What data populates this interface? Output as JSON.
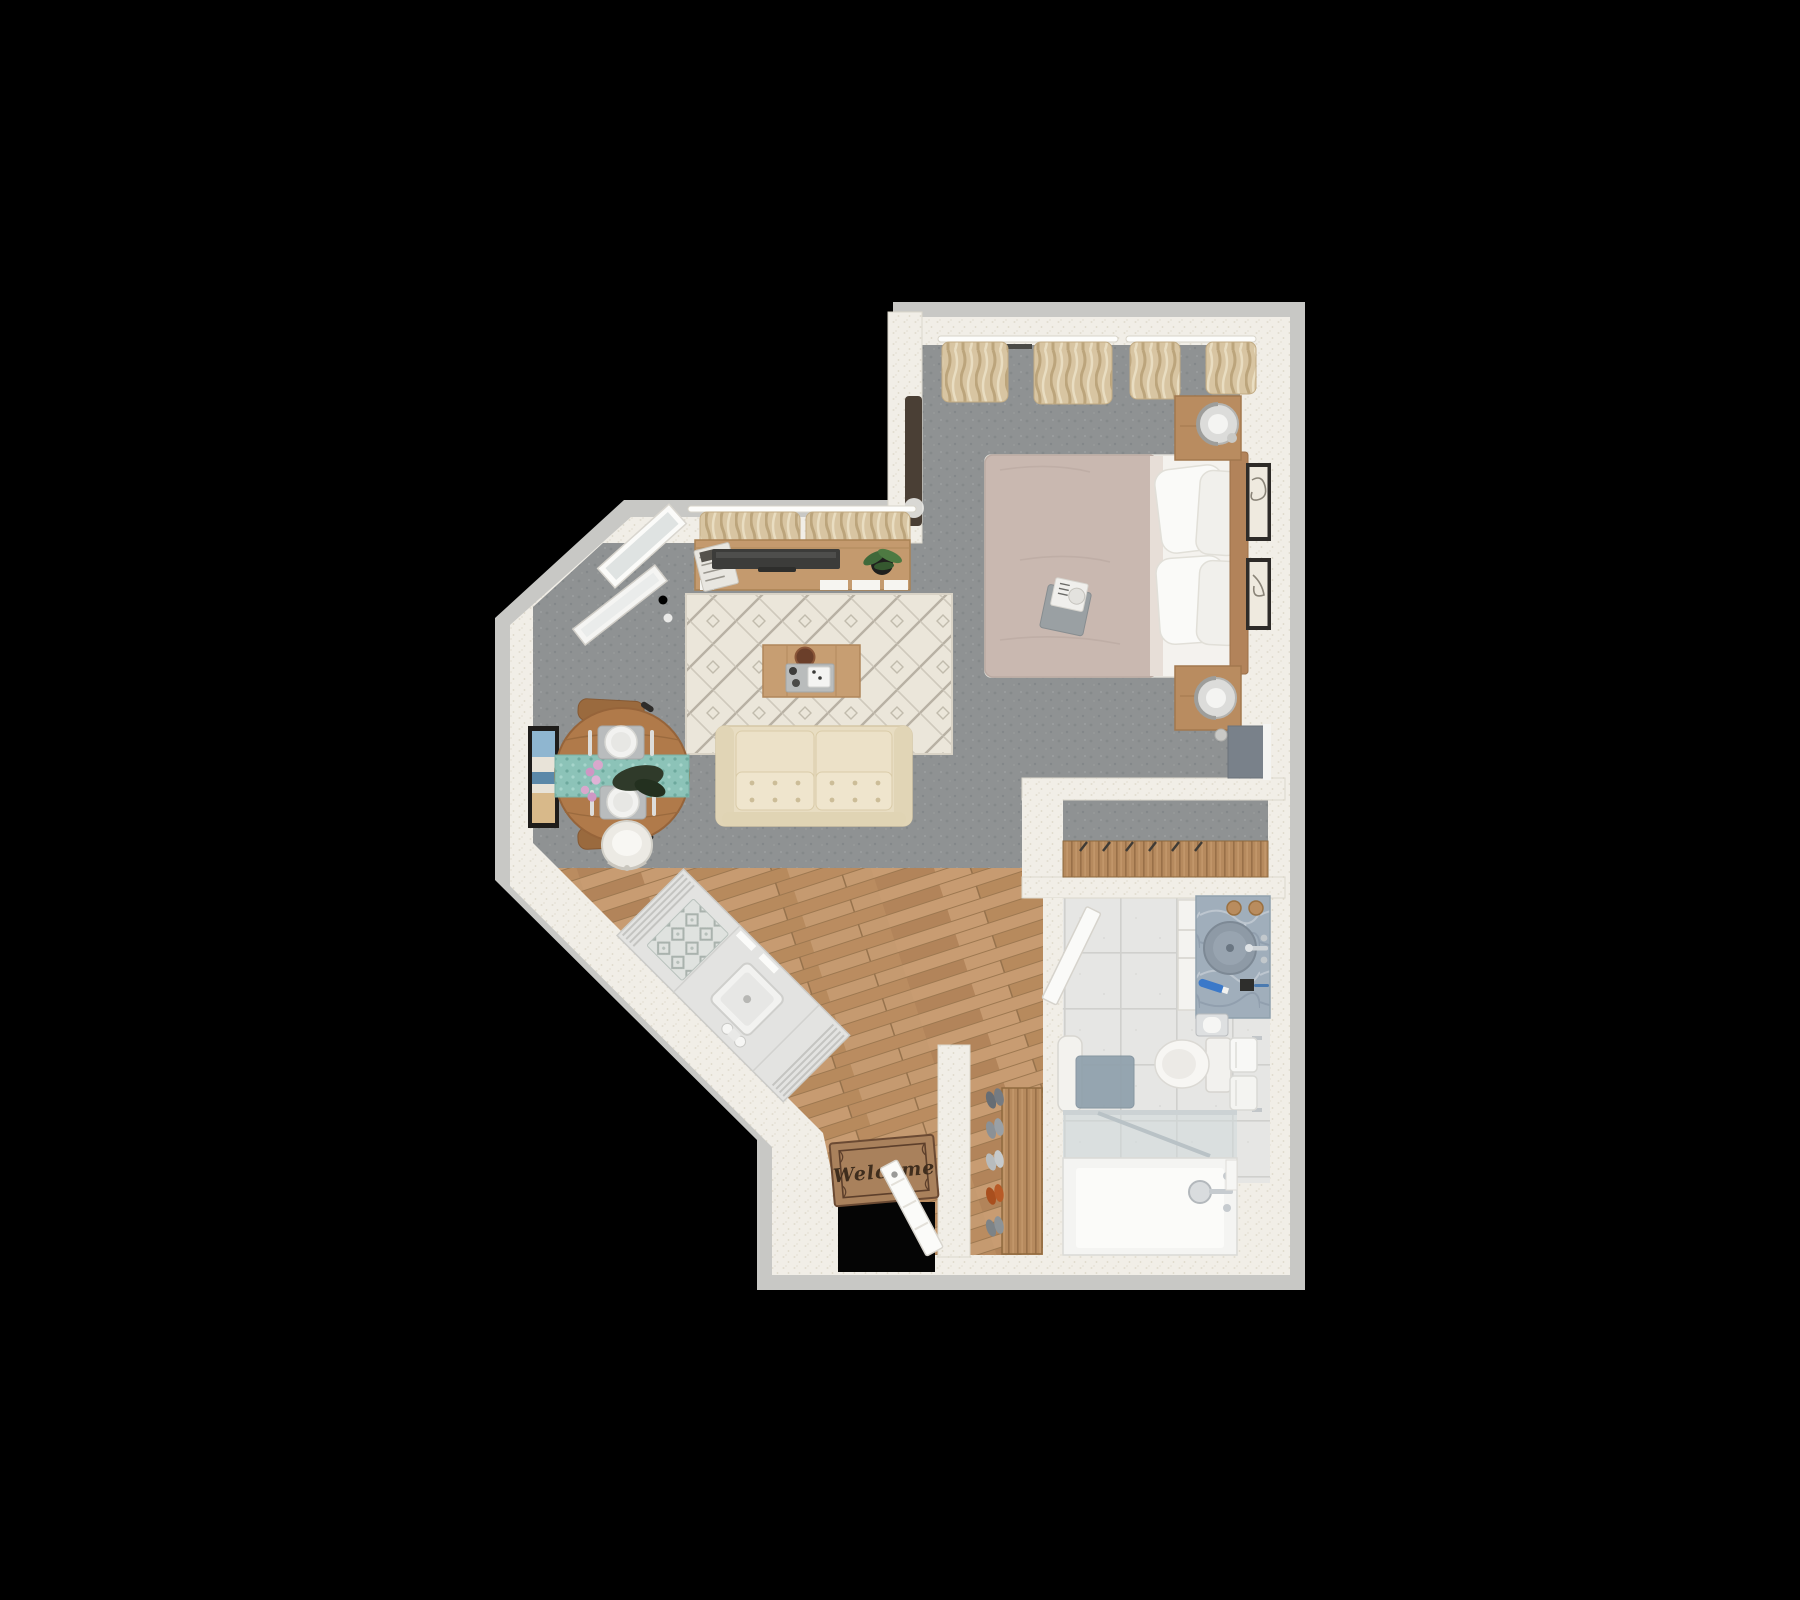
{
  "scene": {
    "description": "3D top-down rendered floor plan of a studio apartment on a black background",
    "background_color": "#000000"
  },
  "entry": {
    "mat_text": "Welcome"
  },
  "palette": {
    "outer_wall": "#c8c8c5",
    "inner_wall": "#f1eee7",
    "carpet": "#8f9293",
    "wood_floor": "#c09569",
    "tile_floor": "#e6e6e4",
    "rug": "#ebe6da",
    "sofa": "#e9dfc4",
    "bed_blanket": "#c9b8b0",
    "wood_furniture": "#b98c60",
    "curtain": "#d8c5a2",
    "runner_teal": "#8cc3b8",
    "vanity_marble": "#a0aebb",
    "door_white": "#fbfbf9"
  },
  "rooms": {
    "bedroom": [
      "bed",
      "pillows",
      "headboard",
      "nightstand-top",
      "nightstand-bottom",
      "lamp-top",
      "lamp-bottom",
      "wall-frames",
      "curtains",
      "breakfast-tray"
    ],
    "living": [
      "media-console",
      "tv",
      "plant",
      "magazines",
      "area-rug",
      "coffee-table",
      "sofa",
      "leaning-mirror",
      "curtains",
      "open-window"
    ],
    "dining": [
      "round-table",
      "table-runner",
      "place-settings",
      "flowers",
      "wood-chairs",
      "white-chair",
      "wall-art"
    ],
    "kitchen": [
      "island-counter",
      "sink",
      "faucet",
      "counter-mat"
    ],
    "entryway": [
      "welcome-mat",
      "front-door",
      "shoe-rack",
      "shoes"
    ],
    "closet": [
      "hanging-rod",
      "hangers",
      "leaning-panel"
    ],
    "bathroom": [
      "vanity",
      "vessel-sink",
      "faucet",
      "toilet",
      "toilet-paper-holder",
      "towel-rack",
      "bench",
      "bath-mat",
      "shower",
      "shower-fixture",
      "bathroom-door"
    ]
  }
}
